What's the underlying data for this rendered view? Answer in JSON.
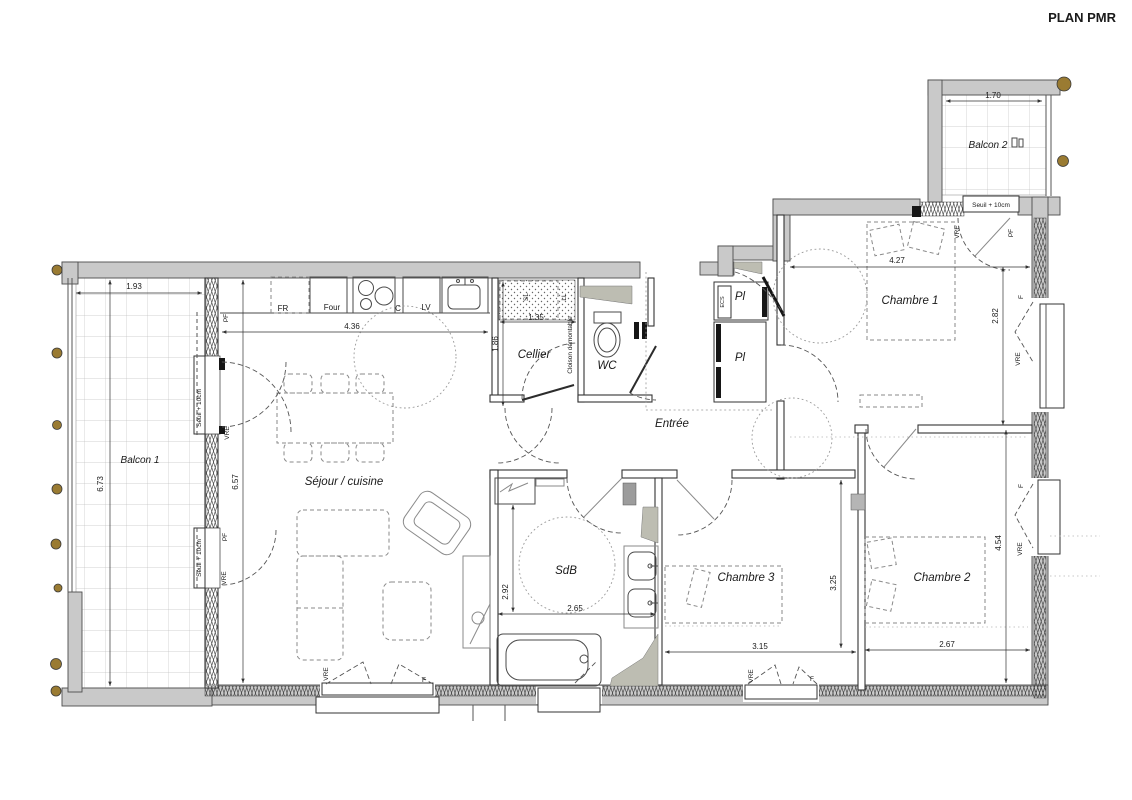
{
  "title": "PLAN PMR",
  "rooms": {
    "balcon1": "Balcon 1",
    "balcon2": "Balcon 2",
    "sejour": "Séjour / cuisine",
    "cellier": "Cellier",
    "wc": "WC",
    "entree": "Entrée",
    "chambre1": "Chambre 1",
    "chambre2": "Chambre 2",
    "chambre3": "Chambre 3",
    "sdb": "SdB",
    "placard": "Pl"
  },
  "dimensions": {
    "balcon1_width": "1.93",
    "balcon1_height": "6.73",
    "balcon2_width": "1.70",
    "kitchen_width": "4.36",
    "sejour_height": "6.57",
    "cellier_width": "1.35",
    "cellier_height": "1.86",
    "chambre1_width": "4.27",
    "chambre1_height": "2.82",
    "chambre2_width": "2.67",
    "chambre2_height": "4.54",
    "chambre3_width": "3.15",
    "chambre3_height": "3.25",
    "sdb_width": "2.65",
    "sdb_height": "2.92"
  },
  "annotations": {
    "seuil": "Seuil + 10cm",
    "cloison": "Cloison démontable"
  },
  "appliances": {
    "fr": "FR",
    "four": "Four",
    "cooktop": "C",
    "lv": "LV",
    "sl": "SL",
    "ll": "LL",
    "ecs": "ECS"
  },
  "openings": {
    "vre": "VRE",
    "f": "F",
    "pf": "PF"
  },
  "colors": {
    "wall": "#c9c9c9",
    "duct": "#bdbdb2",
    "dot": "#9a7b32",
    "line": "#333333"
  }
}
